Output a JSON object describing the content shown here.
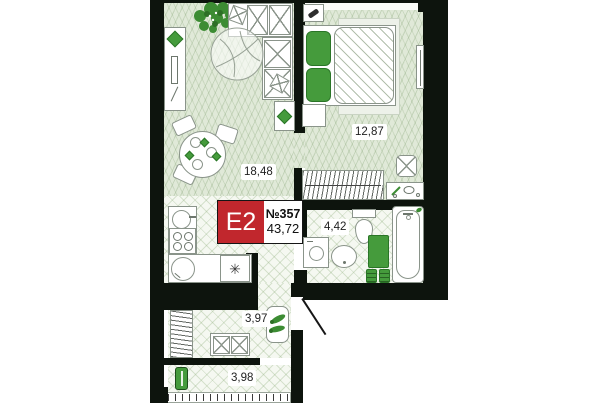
{
  "plan": {
    "badge": {
      "type": "E2",
      "number": "№357",
      "total_area": "43,72"
    },
    "rooms": {
      "living": {
        "area": "18,48"
      },
      "bedroom": {
        "area": "12,87"
      },
      "bathroom": {
        "area": "4,42"
      },
      "hallway": {
        "area": "3,97"
      },
      "balcony": {
        "area": "3,98"
      }
    },
    "icons": {
      "fridge_glyph": "✳"
    },
    "colors": {
      "wall": "#0d140d",
      "floor_living": "#e0e9d8",
      "floor_tile": "#f5f8f1",
      "accent_green": "#459b3c",
      "badge_red": "#c1272d"
    }
  }
}
